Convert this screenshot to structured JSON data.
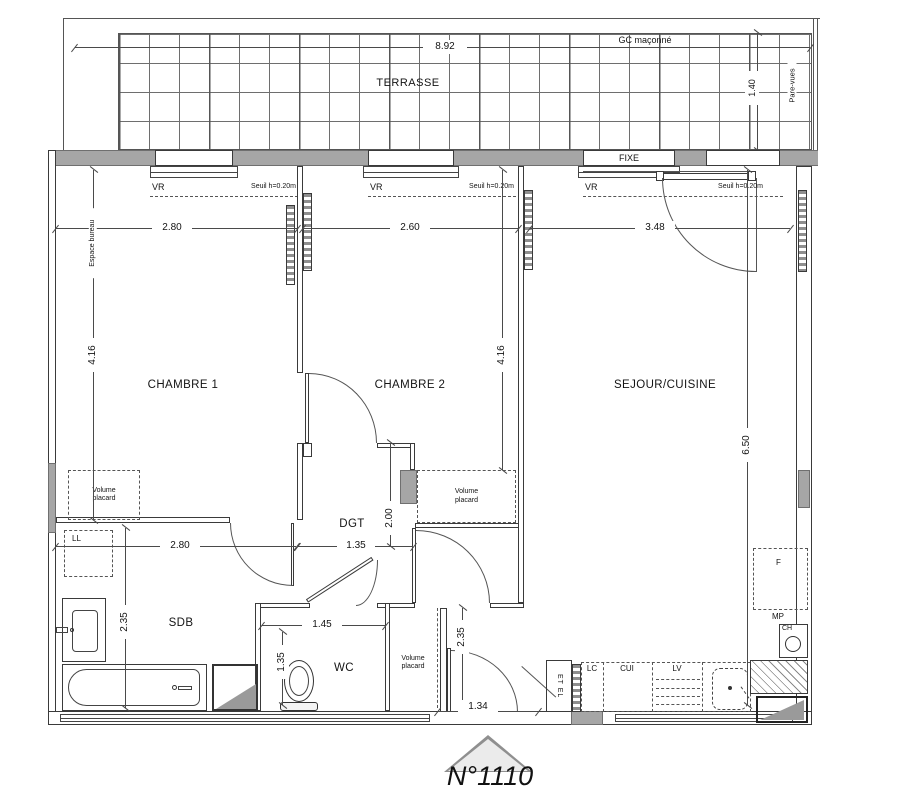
{
  "unit": {
    "number": "N°1110"
  },
  "colors": {
    "line": "#3a3a3a",
    "wall_fill": "#a6a6a6",
    "hatch_fill": "#8f8f8f",
    "background": "#ffffff"
  },
  "terrace": {
    "label": "TERRASSE",
    "width_dim": "8.92",
    "depth_dim": "1.40",
    "gc_label": "GC maçonné",
    "pare_vues": "Pare-vues"
  },
  "windows": {
    "fixe": "FIXE",
    "vr": "VR",
    "seuil": "Seuil h=0.20m"
  },
  "rooms": {
    "chambre1": "CHAMBRE 1",
    "chambre2": "CHAMBRE 2",
    "sejour": "SEJOUR/CUISINE",
    "dgt": "DGT",
    "sdb": "SDB",
    "wc": "WC"
  },
  "features": {
    "volume_placard": "Volume placard",
    "espace_bureau": "Espace bureau",
    "ll": "LL",
    "fridge": "F",
    "mp": "MP",
    "ch": "CH",
    "lc": "LC",
    "cui": "CUI",
    "lv": "LV",
    "etel": "ET EL"
  },
  "dimensions": {
    "ch1_width": "2.80",
    "ch2_width": "2.60",
    "sej_width": "3.48",
    "ch1_depth": "4.16",
    "ch2_depth": "4.16",
    "sej_depth": "6.50",
    "sdb_width": "2.80",
    "dgt_width": "1.35",
    "dgt_depth": "2.00",
    "sdb_depth": "2.35",
    "wc_width": "1.45",
    "wc_depth": "1.35",
    "placard_depth": "2.35",
    "entry_width": "1.34"
  }
}
